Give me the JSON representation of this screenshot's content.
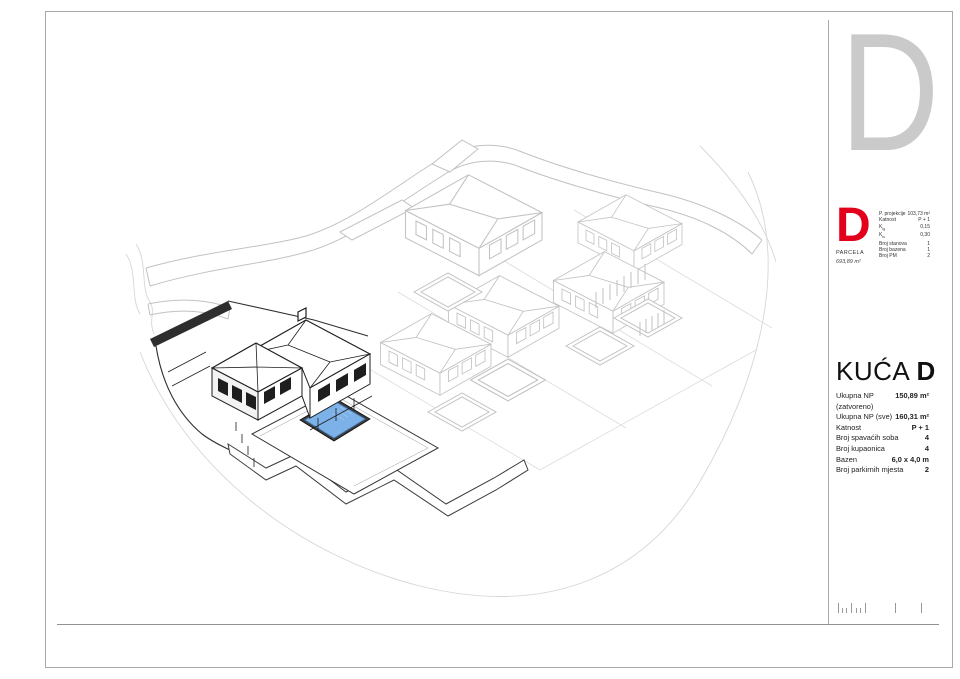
{
  "sheet": {
    "big_letter": "D"
  },
  "parcel_block": {
    "letter": "D",
    "letter_color": "#e2001a",
    "parcela_label": "PARCELA",
    "parcela_area": "693,89 m²",
    "rows": [
      {
        "label": "P. projekcije",
        "value": "103,73 m²"
      },
      {
        "label": "Katnost",
        "value": "P + 1"
      },
      {
        "label": "K",
        "sub": "ig",
        "value": "0,15"
      },
      {
        "label": "K",
        "sub": "is",
        "value": "0,30"
      },
      {
        "label": "Broj stanova",
        "value": "1"
      },
      {
        "label": "Broj bazena",
        "value": "1"
      },
      {
        "label": "Broj PM",
        "value": "2"
      }
    ]
  },
  "house_block": {
    "title_prefix": "KUĆA",
    "title_letter": "D",
    "rows": [
      {
        "label": "Ukupna NP (zatvoreno)",
        "value": "150,89 m²"
      },
      {
        "label": "Ukupna NP (sve)",
        "value": "160,31 m²"
      },
      {
        "label": "Katnost",
        "value": "P + 1"
      },
      {
        "label": "Broj spavaćih soba",
        "value": "4"
      },
      {
        "label": "Broj kupaonica",
        "value": "4"
      },
      {
        "label": "Bazen",
        "value": "6,0 x 4,0 m"
      },
      {
        "label": "Broj parkirnih mjesta",
        "value": "2"
      }
    ]
  },
  "drawing": {
    "type": "axonometric site plan",
    "highlighted_house": "D",
    "pool_color": "#7cb2e8",
    "linework_color": "#c2c2c2",
    "highlight_line_color": "#1e1e1e"
  }
}
